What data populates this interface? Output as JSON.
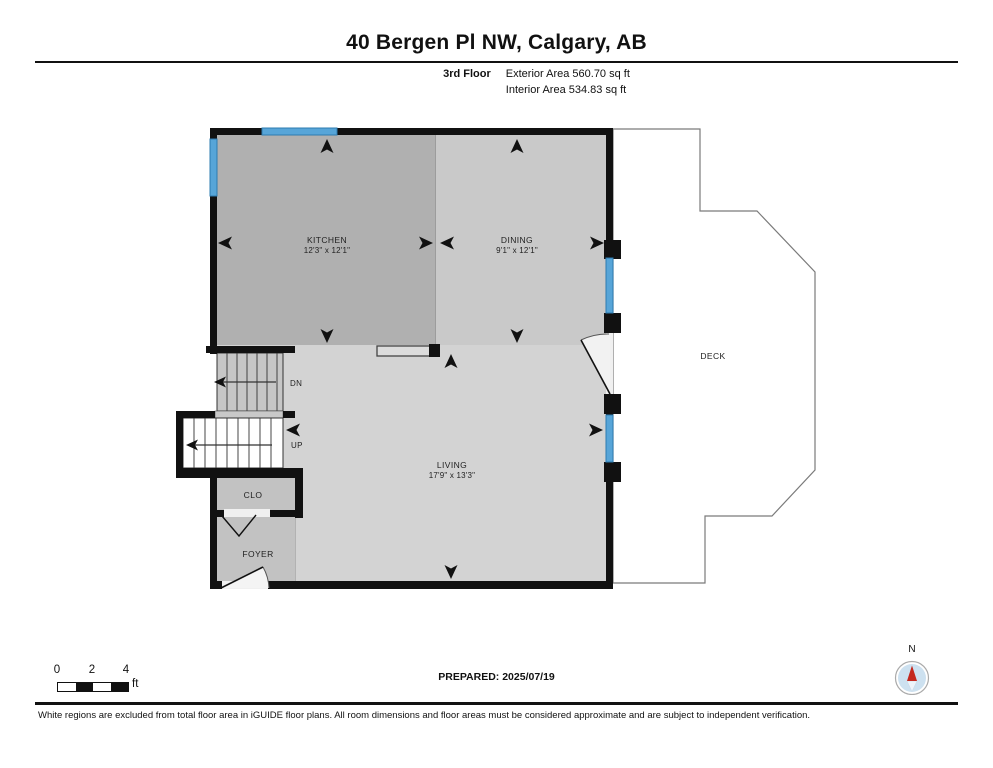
{
  "header": {
    "title": "40 Bergen Pl NW, Calgary, AB",
    "floor_label": "3rd Floor",
    "exterior_area": "Exterior Area 560.70 sq ft",
    "interior_area": "Interior Area 534.83 sq ft"
  },
  "plan": {
    "rooms": {
      "kitchen": {
        "name": "KITCHEN",
        "dims": "12'3\" x 12'1\""
      },
      "dining": {
        "name": "DINING",
        "dims": "9'1\" x 12'1\""
      },
      "living": {
        "name": "LIVING",
        "dims": "17'9\" x 13'3\""
      },
      "deck": {
        "name": "DECK"
      },
      "closet": {
        "name": "CLO"
      },
      "foyer": {
        "name": "FOYER"
      }
    },
    "stairs": {
      "down": "DN",
      "up": "UP"
    },
    "colors": {
      "wall": "#111111",
      "window": "#57a5d8",
      "kitchen_fill": "#b0b0b0",
      "dining_fill": "#c9c9c9",
      "living_fill": "#d3d3d3",
      "foyer_fill": "#c2c2c2",
      "stair_fill": "#c6c6c6",
      "deck_fill": "#ffffff"
    }
  },
  "footer": {
    "scale_bar": {
      "ticks": [
        "0",
        "2",
        "4"
      ],
      "unit": "ft"
    },
    "prepared": "PREPARED: 2025/07/19",
    "compass": "N",
    "disclaimer": "White regions are excluded from total floor area in iGUIDE floor plans. All room dimensions and floor areas must be considered approximate and are subject to independent verification."
  }
}
